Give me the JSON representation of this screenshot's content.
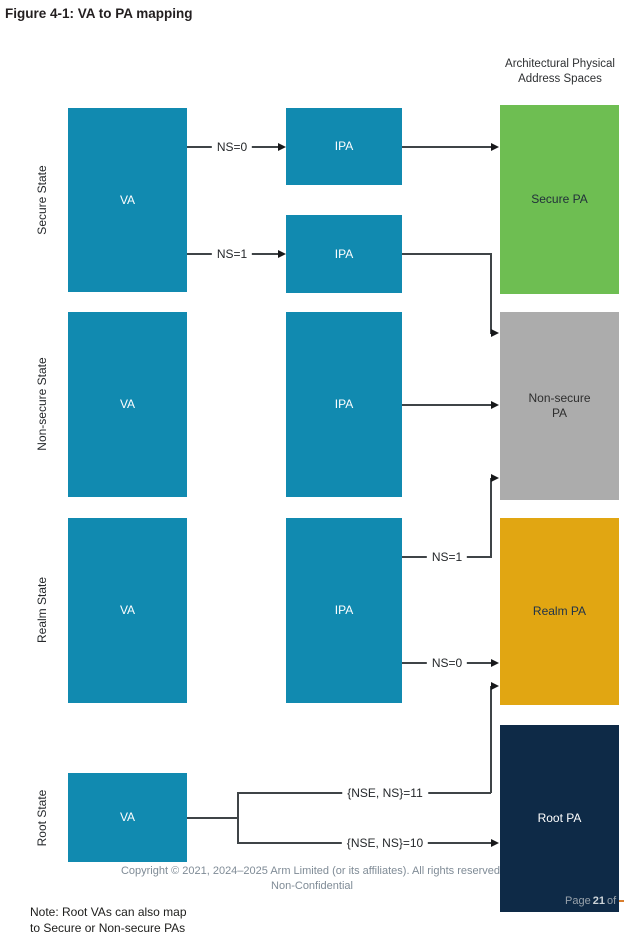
{
  "title": "Figure 4-1: VA to PA mapping",
  "column_header": {
    "line1": "Architectural Physical",
    "line2": "Address Spaces"
  },
  "states": {
    "secure": "Secure State",
    "nonsecure": "Non-secure State",
    "realm": "Realm State",
    "root": "Root State"
  },
  "boxes": {
    "va": "VA",
    "ipa": "IPA",
    "pa_secure": "Secure PA",
    "pa_nonsecure_line1": "Non-secure",
    "pa_nonsecure_line2": "PA",
    "pa_realm": "Realm PA",
    "pa_root": "Root PA"
  },
  "arrow_labels": {
    "secure_ns0": "NS=0",
    "secure_ns1": "NS=1",
    "realm_ns1": "NS=1",
    "realm_ns0": "NS=0",
    "root_nse_ns_11": "{NSE, NS}=11",
    "root_nse_ns_10": "{NSE, NS}=10"
  },
  "colors": {
    "va_ipa": "#118AB0",
    "pa_secure": "#6EBE52",
    "pa_nonsecure": "#ACACAC",
    "pa_realm": "#E1A612",
    "pa_root": "#0E2A47"
  },
  "footer": {
    "copyright": "Copyright © 2021, 2024–2025 Arm Limited (or its affiliates). All rights reserved.",
    "classification": "Non-Confidential",
    "page_prefix": "Page",
    "page_number": "21",
    "page_suffix": "of"
  },
  "note": {
    "line1": "Note: Root VAs can also map",
    "line2": "to Secure or Non-secure PAs"
  }
}
